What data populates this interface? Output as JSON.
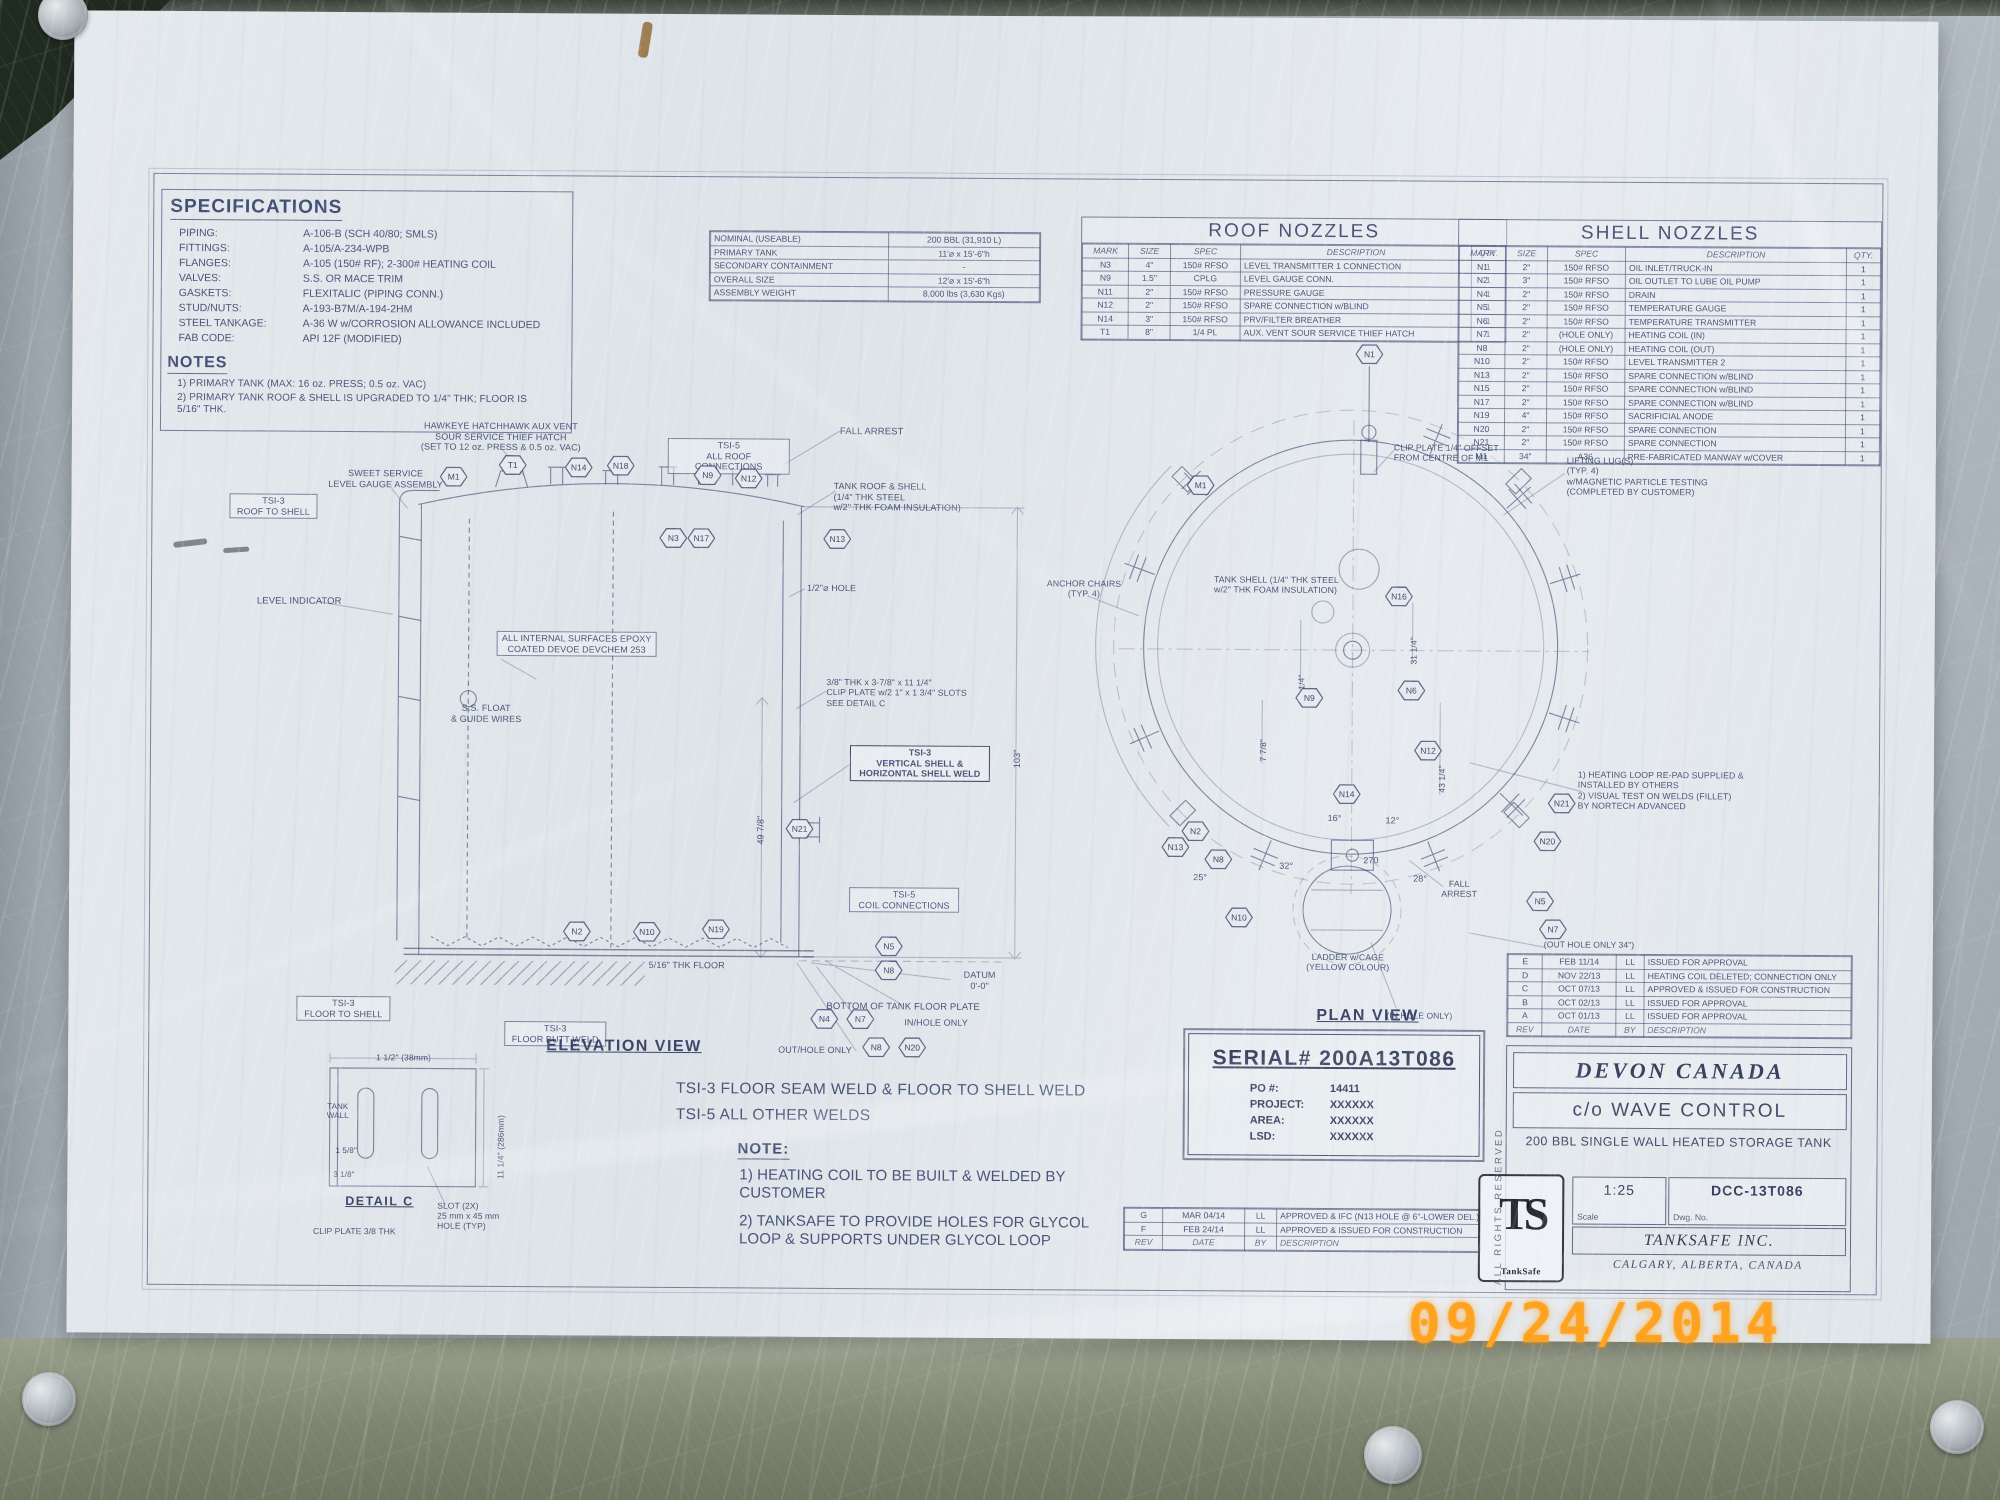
{
  "photo": {
    "date_stamp": "09/24/2014",
    "stamp_color": "#ffa21f"
  },
  "sheet": {
    "specifications": {
      "title": "SPECIFICATIONS",
      "rows": [
        [
          "PIPING:",
          "A-106-B (SCH 40/80; SMLS)"
        ],
        [
          "FITTINGS:",
          "A-105/A-234-WPB"
        ],
        [
          "FLANGES:",
          "A-105 (150# RF); 2-300# HEATING COIL"
        ],
        [
          "VALVES:",
          "S.S. OR MACE TRIM"
        ],
        [
          "GASKETS:",
          "FLEXITALIC (PIPING CONN.)"
        ],
        [
          "STUD/NUTS:",
          "A-193-B7M/A-194-2HM"
        ],
        [
          "STEEL TANKAGE:",
          "A-36 W w/CORROSION ALLOWANCE INCLUDED"
        ],
        [
          "FAB CODE:",
          "API 12F (MODIFIED)"
        ]
      ],
      "notes_title": "NOTES",
      "notes": [
        "1) PRIMARY TANK (MAX: 16 oz. PRESS; 0.5 oz. VAC)",
        "2) PRIMARY TANK ROOF & SHELL IS UPGRADED TO 1/4\" THK; FLOOR IS 5/16\" THK."
      ]
    },
    "capacity_table": {
      "rows": [
        [
          "NOMINAL (USEABLE)",
          "200 BBL (31,910 L)"
        ],
        [
          "PRIMARY TANK",
          "11'⌀ x 15'-6\"h"
        ],
        [
          "SECONDARY CONTAINMENT",
          "-"
        ],
        [
          "OVERALL SIZE",
          "12'⌀ x 15'-6\"h"
        ],
        [
          "ASSEMBLY WEIGHT",
          "8,000 lbs (3,630 Kgs)"
        ]
      ]
    },
    "roof_nozzles": {
      "title": "ROOF NOZZLES",
      "cols": [
        "MARK",
        "SIZE",
        "SPEC",
        "DESCRIPTION",
        "QTY."
      ],
      "rows": [
        [
          "N3",
          "4\"",
          "150# RFSO",
          "LEVEL TRANSMITTER 1 CONNECTION",
          "1"
        ],
        [
          "N9",
          "1.5\"",
          "CPLG",
          "LEVEL GAUGE CONN.",
          "1"
        ],
        [
          "N11",
          "2\"",
          "150# RFSO",
          "PRESSURE GAUGE",
          "1"
        ],
        [
          "N12",
          "2\"",
          "150# RFSO",
          "SPARE CONNECTION w/BLIND",
          "1"
        ],
        [
          "N14",
          "3\"",
          "150# RFSO",
          "PRV/FILTER BREATHER",
          "1"
        ],
        [
          "T1",
          "8\"",
          "1/4 PL",
          "AUX. VENT SOUR SERVICE THIEF HATCH",
          "1"
        ]
      ]
    },
    "shell_nozzles": {
      "title": "SHELL NOZZLES",
      "cols": [
        "MARK",
        "SIZE",
        "SPEC",
        "DESCRIPTION",
        "QTY."
      ],
      "rows": [
        [
          "N1",
          "2\"",
          "150# RFSO",
          "OIL INLET/TRUCK-IN",
          "1"
        ],
        [
          "N2",
          "3\"",
          "150# RFSO",
          "OIL OUTLET TO LUBE OIL PUMP",
          "1"
        ],
        [
          "N4",
          "2\"",
          "150# RFSO",
          "DRAIN",
          "1"
        ],
        [
          "N5",
          "2\"",
          "150# RFSO",
          "TEMPERATURE GAUGE",
          "1"
        ],
        [
          "N6",
          "2\"",
          "150# RFSO",
          "TEMPERATURE TRANSMITTER",
          "1"
        ],
        [
          "N7",
          "2\"",
          "(HOLE ONLY)",
          "HEATING COIL (IN)",
          "1"
        ],
        [
          "N8",
          "2\"",
          "(HOLE ONLY)",
          "HEATING COIL (OUT)",
          "1"
        ],
        [
          "N10",
          "2\"",
          "150# RFSO",
          "LEVEL TRANSMITTER 2",
          "1"
        ],
        [
          "N13",
          "2\"",
          "150# RFSO",
          "SPARE CONNECTION w/BLIND",
          "1"
        ],
        [
          "N15",
          "2\"",
          "150# RFSO",
          "SPARE CONNECTION w/BLIND",
          "1"
        ],
        [
          "N17",
          "2\"",
          "150# RFSO",
          "SPARE CONNECTION w/BLIND",
          "1"
        ],
        [
          "N19",
          "4\"",
          "150# RFSO",
          "SACRIFICIAL ANODE",
          "1"
        ],
        [
          "N20",
          "2\"",
          "150# RFSO",
          "SPARE CONNECTION",
          "1"
        ],
        [
          "N21",
          "2\"",
          "150# RFSO",
          "SPARE CONNECTION",
          "1"
        ],
        [
          "M1",
          "34\"",
          "A36",
          "PRE-FABRICATED MANWAY w/COVER",
          "1"
        ]
      ]
    },
    "elevation": {
      "title": "ELEVATION VIEW",
      "labels": [
        {
          "t": "HAWKEYE HATCHHAWK AUX VENT\nSOUR SERVICE THIEF HATCH\n(SET TO 12 oz. PRESS & 0.5 oz. VAC)",
          "x": 383,
          "y": 424,
          "w": 232,
          "al": "c",
          "s": 9
        },
        {
          "t": "TSI-5\nALL ROOF CONNECTIONS",
          "x": 666,
          "y": 440,
          "w": 114,
          "al": "c",
          "b": 1,
          "s": 9
        },
        {
          "t": "FALL ARREST",
          "x": 838,
          "y": 427
        },
        {
          "t": "TANK ROOF & SHELL\n(1/4\" THK STEEL\nw/2\" THK FOAM INSULATION)",
          "x": 832,
          "y": 482,
          "w": 160,
          "s": 9
        },
        {
          "t": "SWEET SERVICE\nLEVEL GAUGE ASSEMBLY",
          "x": 318,
          "y": 472,
          "w": 132,
          "al": "c",
          "s": 9
        },
        {
          "t": "TSI-3\nROOF TO SHELL",
          "x": 228,
          "y": 498,
          "w": 80,
          "al": "c",
          "b": 1,
          "s": 9
        },
        {
          "t": "LEVEL INDICATOR",
          "x": 256,
          "y": 600
        },
        {
          "t": "1/2\"⌀ HOLE",
          "x": 806,
          "y": 584,
          "s": 9
        },
        {
          "t": "ALL INTERNAL SURFACES EPOXY\nCOATED DEVOE DEVCHEM 253",
          "x": 496,
          "y": 634,
          "w": 152,
          "al": "c",
          "b": 1,
          "s": 9
        },
        {
          "t": "S.S. FLOAT\n& GUIDE WIRES",
          "x": 440,
          "y": 706,
          "w": 92,
          "al": "c",
          "s": 9
        },
        {
          "t": "3/8\" THK x 3-7/8\" x 11 1/4\"\nCLIP PLATE w/2 1\" x 1 3/4\" SLOTS\nSEE DETAIL C",
          "x": 826,
          "y": 678,
          "w": 172,
          "s": 8.7
        },
        {
          "t": "TSI-3\nVERTICAL SHELL &\nHORIZONTAL SHELL WELD",
          "x": 850,
          "y": 746,
          "w": 132,
          "al": "c",
          "b": 2,
          "s": 9
        },
        {
          "t": "49 7/8\"",
          "x": 756,
          "y": 846,
          "r": 1,
          "s": 9
        },
        {
          "t": "103\"",
          "x": 1012,
          "y": 768,
          "r": 1,
          "s": 9
        },
        {
          "t": "TSI-5\nCOIL CONNECTIONS",
          "x": 850,
          "y": 888,
          "w": 102,
          "al": "c",
          "b": 1,
          "s": 9
        },
        {
          "t": "5/16\" THK FLOOR",
          "x": 650,
          "y": 962,
          "s": 9
        },
        {
          "t": "DATUM\n0'-0\"",
          "x": 950,
          "y": 970,
          "w": 62,
          "al": "c",
          "s": 9
        },
        {
          "t": "BOTTOM OF TANK FLOOR PLATE",
          "x": 828,
          "y": 1002
        },
        {
          "t": "TSI-3\nFLOOR TO SHELL",
          "x": 298,
          "y": 1000,
          "w": 86,
          "al": "c",
          "b": 1,
          "s": 9
        },
        {
          "t": "TSI-3\nFLOOR BUTT WELD",
          "x": 506,
          "y": 1024,
          "w": 94,
          "al": "c",
          "b": 1,
          "s": 9
        },
        {
          "t": "IN/HOLE ONLY",
          "x": 906,
          "y": 1018,
          "s": 9
        },
        {
          "t": "OUT/HOLE ONLY",
          "x": 780,
          "y": 1046,
          "s": 9
        }
      ],
      "hexes": [
        {
          "t": "M1",
          "x": 452,
          "y": 480
        },
        {
          "t": "T1",
          "x": 511,
          "y": 468
        },
        {
          "t": "N14",
          "x": 577,
          "y": 470
        },
        {
          "t": "N18",
          "x": 619,
          "y": 468
        },
        {
          "t": "N9",
          "x": 706,
          "y": 477
        },
        {
          "t": "N12",
          "x": 747,
          "y": 480
        },
        {
          "t": "N3",
          "x": 672,
          "y": 540
        },
        {
          "t": "N17",
          "x": 700,
          "y": 540
        },
        {
          "t": "N13",
          "x": 836,
          "y": 540
        },
        {
          "t": "N21",
          "x": 800,
          "y": 830
        },
        {
          "t": "N2",
          "x": 578,
          "y": 934
        },
        {
          "t": "N10",
          "x": 648,
          "y": 934
        },
        {
          "t": "N19",
          "x": 717,
          "y": 931
        },
        {
          "t": "N5",
          "x": 890,
          "y": 947
        },
        {
          "t": "N8",
          "x": 890,
          "y": 971
        },
        {
          "t": "N4",
          "x": 826,
          "y": 1020
        },
        {
          "t": "N7",
          "x": 862,
          "y": 1020
        },
        {
          "t": "N8",
          "x": 878,
          "y": 1048
        },
        {
          "t": "N20",
          "x": 914,
          "y": 1048
        }
      ]
    },
    "detail_c": {
      "title": "DETAIL C",
      "labels": [
        {
          "t": "1 1/2\" (38mm)",
          "x": 378,
          "y": 1056,
          "s": 8.5
        },
        {
          "t": "TANK\nWALL",
          "x": 320,
          "y": 1106,
          "w": 40,
          "al": "c",
          "s": 8
        },
        {
          "t": "1 5/8\"",
          "x": 338,
          "y": 1150,
          "s": 8
        },
        {
          "t": "3 1/8\"",
          "x": 336,
          "y": 1174,
          "s": 8
        },
        {
          "t": "11 1/4\" (286mm)",
          "x": 498,
          "y": 1182,
          "r": 1,
          "s": 8.5
        },
        {
          "t": "CLIP PLATE 3/8 THK",
          "x": 316,
          "y": 1230,
          "s": 8.5
        },
        {
          "t": "SLOT (2X)\n25 mm x 45 mm\nHOLE (TYP)",
          "x": 440,
          "y": 1204,
          "w": 92,
          "s": 8.5
        }
      ]
    },
    "plan": {
      "title": "PLAN VIEW",
      "labels": [
        {
          "t": "CLIP PLATE 1/4\" OFFSET\nFROM CENTRE OF M1",
          "x": 1392,
          "y": 440,
          "w": 142,
          "s": 8.7
        },
        {
          "t": "LIFTING LUG(S)\n(TYP. 4)\nw/MAGNETIC PARTICLE TESTING\n(COMPLETED BY CUSTOMER)",
          "x": 1565,
          "y": 452,
          "w": 192,
          "s": 8.7
        },
        {
          "t": "ANCHOR CHAIRS\n(TYP. 4)",
          "x": 1032,
          "y": 578,
          "w": 102,
          "al": "c",
          "s": 8.7
        },
        {
          "t": "TANK SHELL (1/4\" THK STEEL\nw/2\" THK FOAM INSULATION)",
          "x": 1213,
          "y": 573,
          "w": 162,
          "s": 8.7
        },
        {
          "t": "1) HEATING LOOP RE-PAD SUPPLIED &\n     INSTALLED BY OTHERS\n2) VISUAL TEST ON WELDS (FILLET)\n     BY NORTECH ADVANCED",
          "x": 1578,
          "y": 766,
          "w": 212,
          "s": 8.7
        },
        {
          "t": "FALL\nARREST",
          "x": 1430,
          "y": 876,
          "w": 60,
          "al": "c",
          "s": 8.7
        },
        {
          "t": "LADDER w/CAGE\n(YELLOW COLOUR)",
          "x": 1298,
          "y": 950,
          "w": 102,
          "al": "c",
          "s": 8.7
        },
        {
          "t": "(IN HOLE ONLY)",
          "x": 1388,
          "y": 1008,
          "s": 8.5
        },
        {
          "t": "(OUT HOLE ONLY 34\")",
          "x": 1545,
          "y": 936,
          "s": 8.5
        },
        {
          "t": "270",
          "x": 1364,
          "y": 853,
          "s": 9
        },
        {
          "t": "28°",
          "x": 1414,
          "y": 871,
          "s": 9
        },
        {
          "t": "16°",
          "x": 1328,
          "y": 811,
          "s": 9
        },
        {
          "t": "12°",
          "x": 1386,
          "y": 813,
          "s": 9
        },
        {
          "t": "32°",
          "x": 1280,
          "y": 859,
          "s": 9
        },
        {
          "t": "25°",
          "x": 1194,
          "y": 871,
          "s": 9
        },
        {
          "t": "43 1/4\"",
          "x": 1437,
          "y": 790,
          "r": 1,
          "s": 8.5
        },
        {
          "t": "31 1/4\"",
          "x": 1408,
          "y": 662,
          "r": 1,
          "s": 8.5
        },
        {
          "t": "18 1/4\"",
          "x": 1296,
          "y": 700,
          "r": 1,
          "s": 8.5
        },
        {
          "t": "7 7/8\"",
          "x": 1258,
          "y": 760,
          "r": 1,
          "s": 8.5
        }
      ],
      "hexes": [
        {
          "t": "N1",
          "x": 1367,
          "y": 352
        },
        {
          "t": "M1",
          "x": 1199,
          "y": 484
        },
        {
          "t": "N16",
          "x": 1398,
          "y": 594
        },
        {
          "t": "N9",
          "x": 1309,
          "y": 696
        },
        {
          "t": "N6",
          "x": 1411,
          "y": 688
        },
        {
          "t": "N12",
          "x": 1428,
          "y": 748
        },
        {
          "t": "N14",
          "x": 1347,
          "y": 792
        },
        {
          "t": "N2",
          "x": 1196,
          "y": 830
        },
        {
          "t": "N13",
          "x": 1176,
          "y": 846
        },
        {
          "t": "N8",
          "x": 1219,
          "y": 858
        },
        {
          "t": "N10",
          "x": 1240,
          "y": 916
        },
        {
          "t": "N20",
          "x": 1548,
          "y": 838
        },
        {
          "t": "N21",
          "x": 1562,
          "y": 800
        },
        {
          "t": "N5",
          "x": 1541,
          "y": 898
        },
        {
          "t": "N7",
          "x": 1554,
          "y": 926
        }
      ]
    },
    "weld_notes": {
      "line1": "TSI-3 FLOOR SEAM WELD & FLOOR TO SHELL WELD",
      "line2": "TSI-5 ALL OTHER WELDS",
      "note_title": "NOTE:",
      "note1": "1) HEATING COIL TO BE BUILT & WELDED BY\n     CUSTOMER",
      "note2": "2) TANKSAFE TO PROVIDE HOLES FOR GLYCOL\n     LOOP & SUPPORTS UNDER GLYCOL LOOP"
    },
    "serial_block": {
      "serial": "SERIAL# 200A13T086",
      "rows": [
        [
          "PO #:",
          "14411"
        ],
        [
          "PROJECT:",
          "XXXXXX"
        ],
        [
          "AREA:",
          "XXXXXX"
        ],
        [
          "LSD:",
          "XXXXXX"
        ]
      ]
    },
    "rev_table_right": {
      "rows": [
        [
          "E",
          "FEB 11/14",
          "LL",
          "ISSUED FOR APPROVAL"
        ],
        [
          "D",
          "NOV 22/13",
          "LL",
          "HEATING COIL DELETED; CONNECTION ONLY"
        ],
        [
          "C",
          "OCT 07/13",
          "LL",
          "APPROVED & ISSUED FOR CONSTRUCTION"
        ],
        [
          "B",
          "OCT 02/13",
          "LL",
          "ISSUED FOR APPROVAL"
        ],
        [
          "A",
          "OCT 01/13",
          "LL",
          "ISSUED FOR APPROVAL"
        ],
        [
          "REV",
          "DATE",
          "BY",
          "DESCRIPTION"
        ]
      ]
    },
    "rev_table_bottom": {
      "rows": [
        [
          "G",
          "MAR 04/14",
          "LL",
          "APPROVED & IFC (N13 HOLE @ 6\"-LOWER DEL.)"
        ],
        [
          "F",
          "FEB 24/14",
          "LL",
          "APPROVED & ISSUED FOR CONSTRUCTION"
        ],
        [
          "REV",
          "DATE",
          "BY",
          "DESCRIPTION"
        ]
      ]
    },
    "title_block": {
      "company": "DEVON CANADA",
      "care_of": "c/o WAVE CONTROL",
      "description": "200 BBL SINGLE WALL HEATED STORAGE TANK",
      "scale_label": "Scale",
      "scale": "1:25",
      "dwg_label": "Dwg. No.",
      "dwg_no": "DCC-13T086",
      "manufacturer": "TANKSAFE INC.",
      "location": "CALGARY, ALBERTA, CANADA",
      "rights": "ALL RIGHTS RESERVED",
      "logo_monogram": "TS",
      "logo_sub": "TankSafe"
    }
  }
}
